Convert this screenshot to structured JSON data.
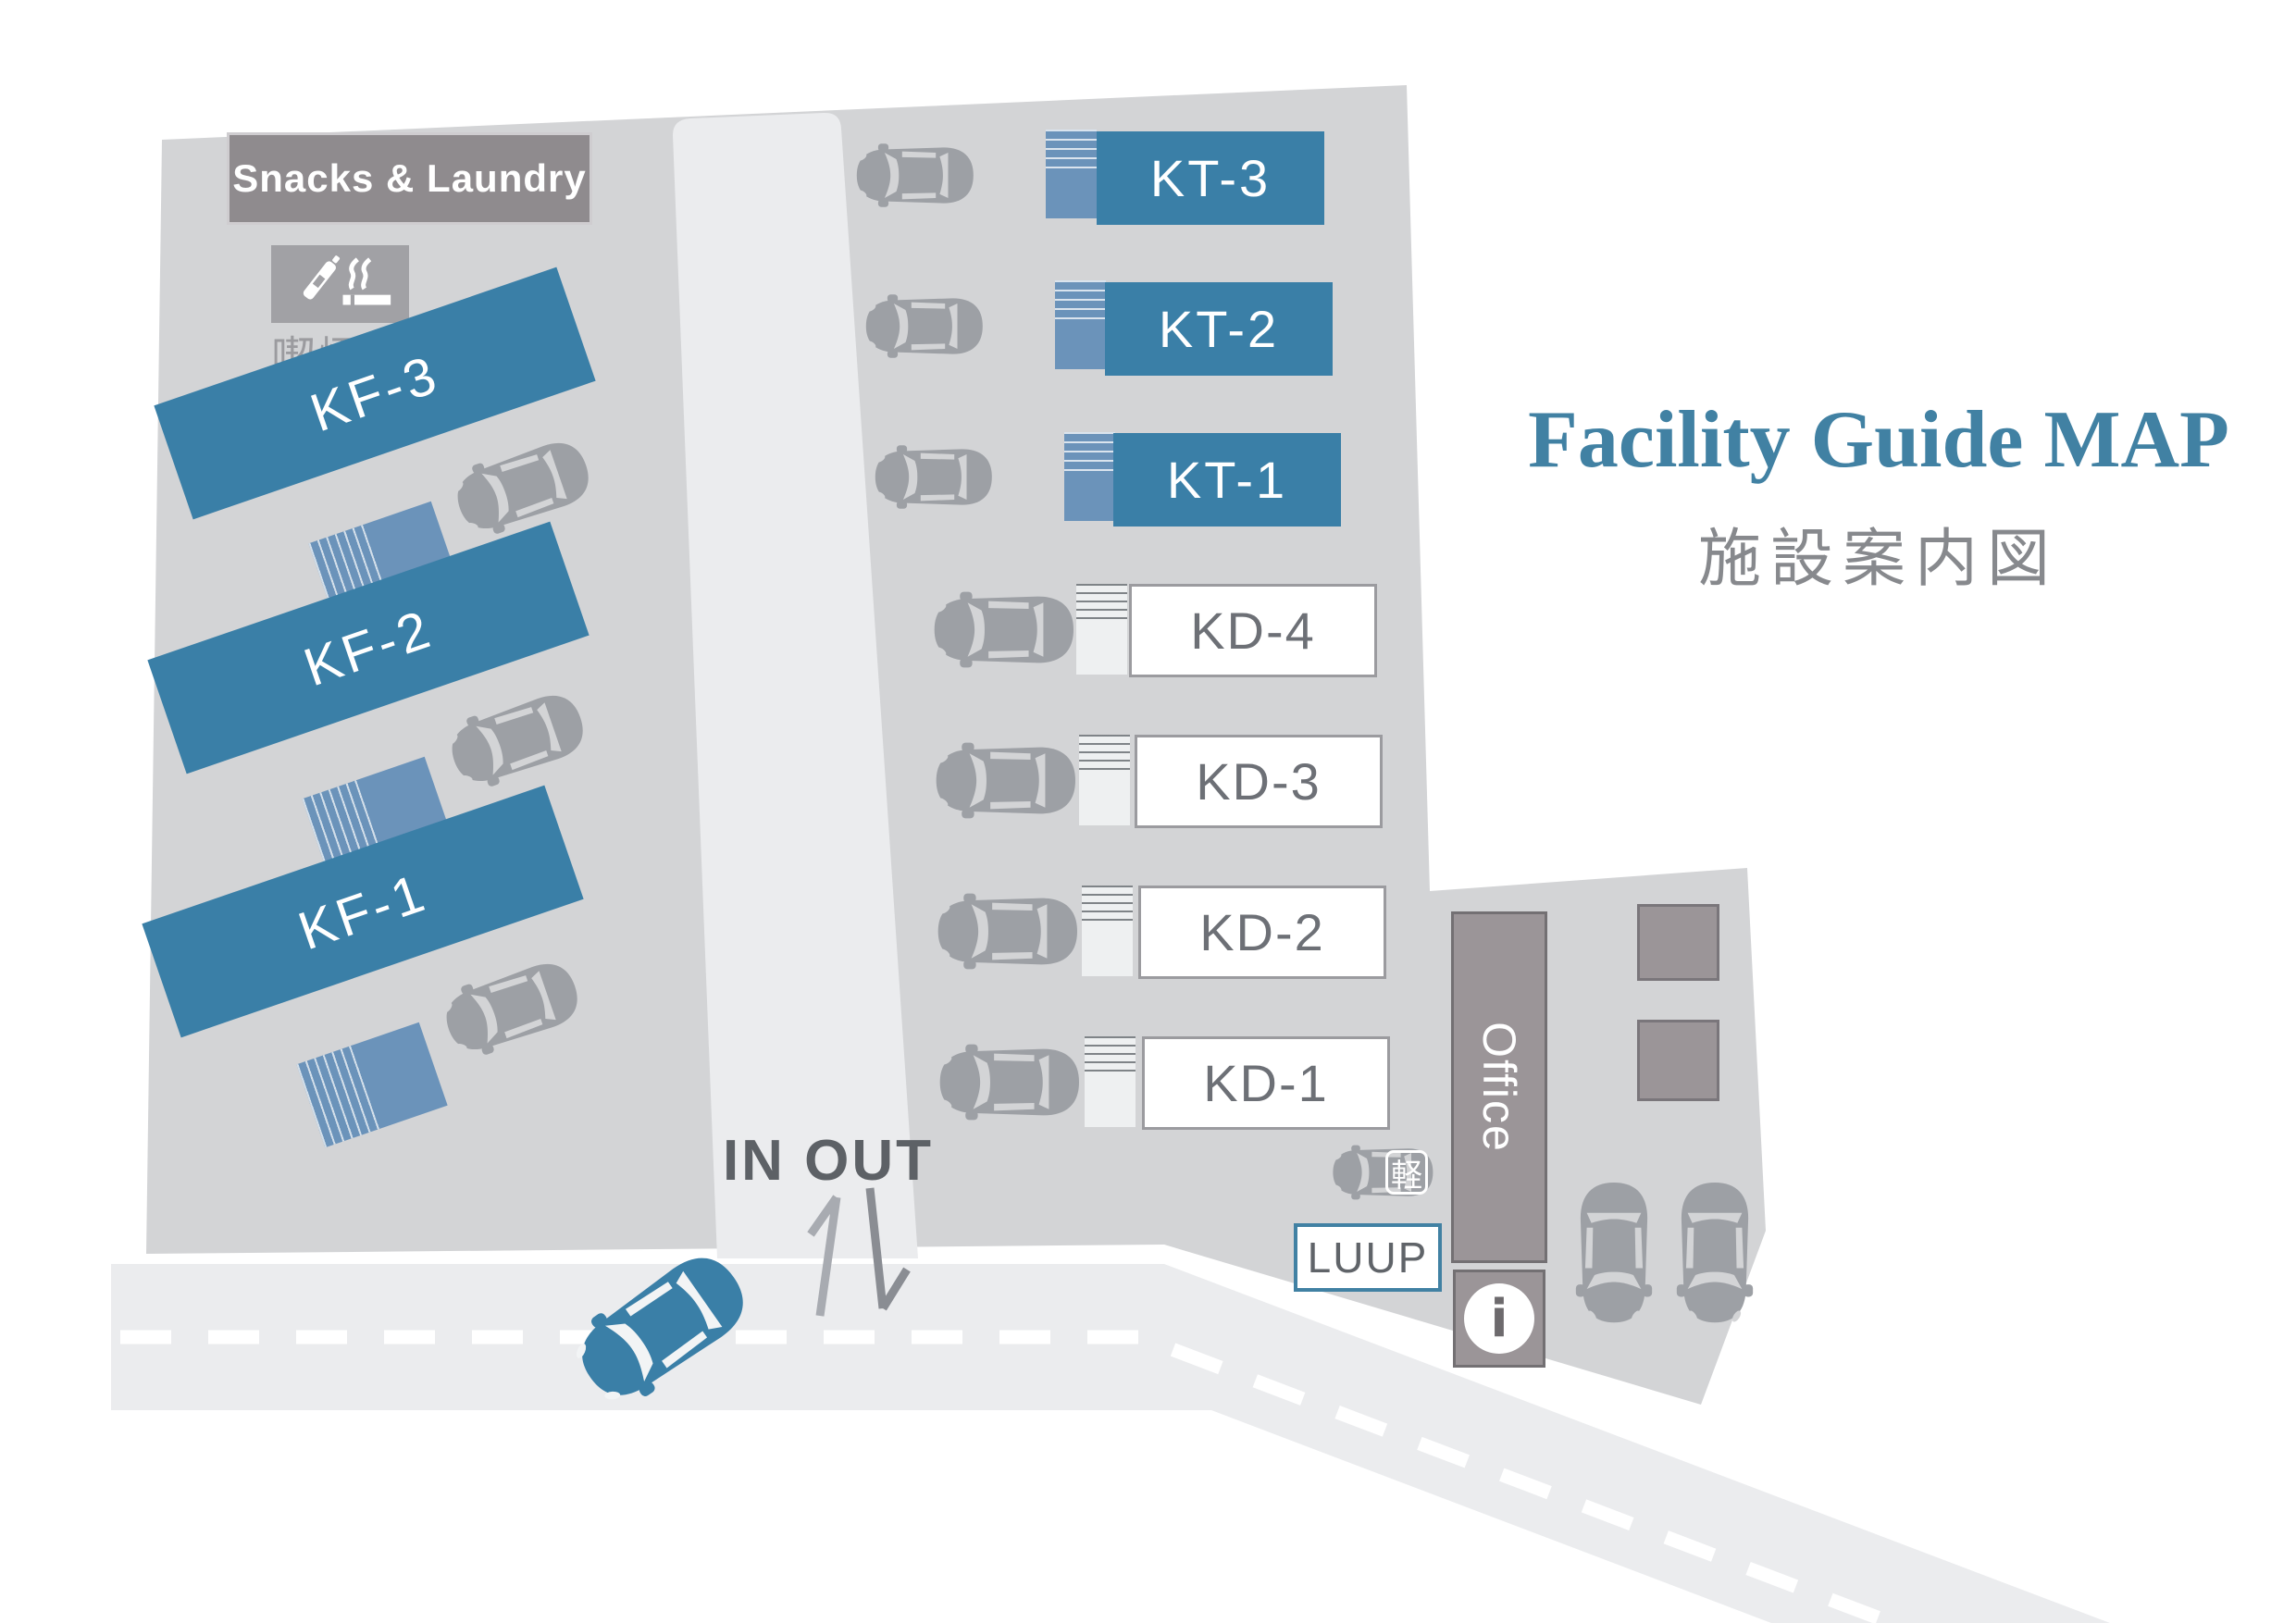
{
  "title": "Facility Guide MAP",
  "subtitle": "施設案内図",
  "map": {
    "snacks_laundry_label": "Snacks & Laundry",
    "smoking_area_label": "喫煙所",
    "kf_buildings": [
      {
        "label": "KF-3"
      },
      {
        "label": "KF-2"
      },
      {
        "label": "KF-1"
      }
    ],
    "kt_buildings": [
      {
        "label": "KT-3"
      },
      {
        "label": "KT-2"
      },
      {
        "label": "KT-1"
      }
    ],
    "kd_buildings": [
      {
        "label": "KD-4"
      },
      {
        "label": "KD-3"
      },
      {
        "label": "KD-2"
      },
      {
        "label": "KD-1"
      }
    ],
    "office_label": "Office",
    "info_glyph": "i",
    "luup_label": "LUUP",
    "kei_label": "軽",
    "in_out_label": "IN OUT"
  },
  "colors": {
    "building_blue": "#3a7fa7",
    "entrance_blue": "#6b93ba",
    "title_blue": "#4181a3",
    "facility_gray": "#d3d4d6",
    "road_gray": "#ebecee",
    "sign_gray": "#8f8b8e",
    "office_gray": "#9b9598",
    "car_gray": "#9da0a5",
    "text_gray": "#6d7076"
  }
}
